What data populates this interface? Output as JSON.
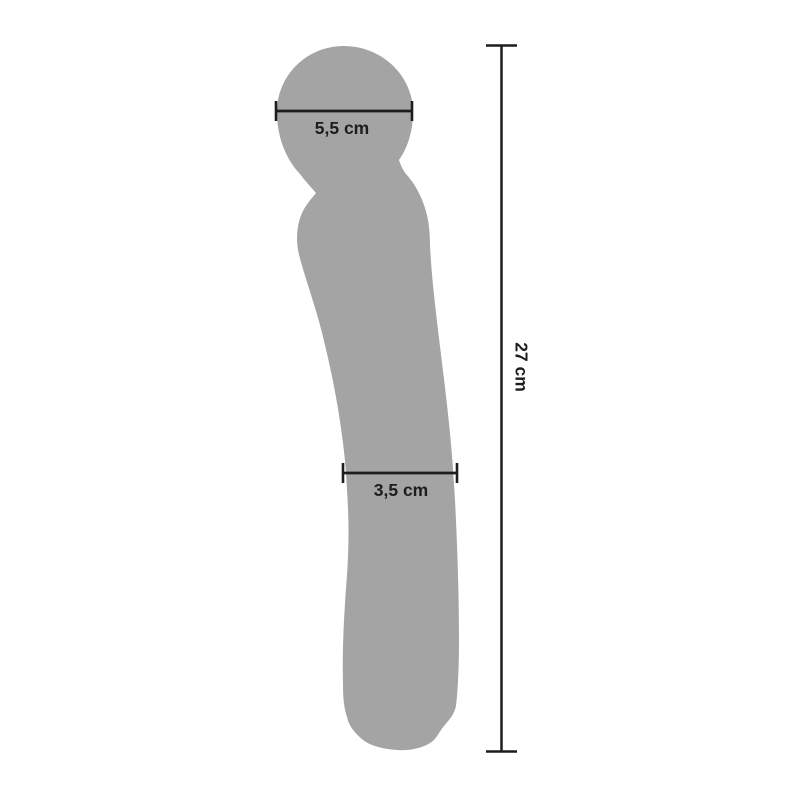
{
  "colors": {
    "background": "#ffffff",
    "silhouette": "#a4a4a4",
    "measurement": "#1d1d1b"
  },
  "measurements": {
    "head_width": {
      "label": "5,5 cm",
      "value": "5,5",
      "unit": "cm"
    },
    "shaft_width": {
      "label": "3,5 cm",
      "value": "3,5",
      "unit": "cm"
    },
    "total_length": {
      "label": "27 cm",
      "value": "27",
      "unit": "cm"
    }
  }
}
